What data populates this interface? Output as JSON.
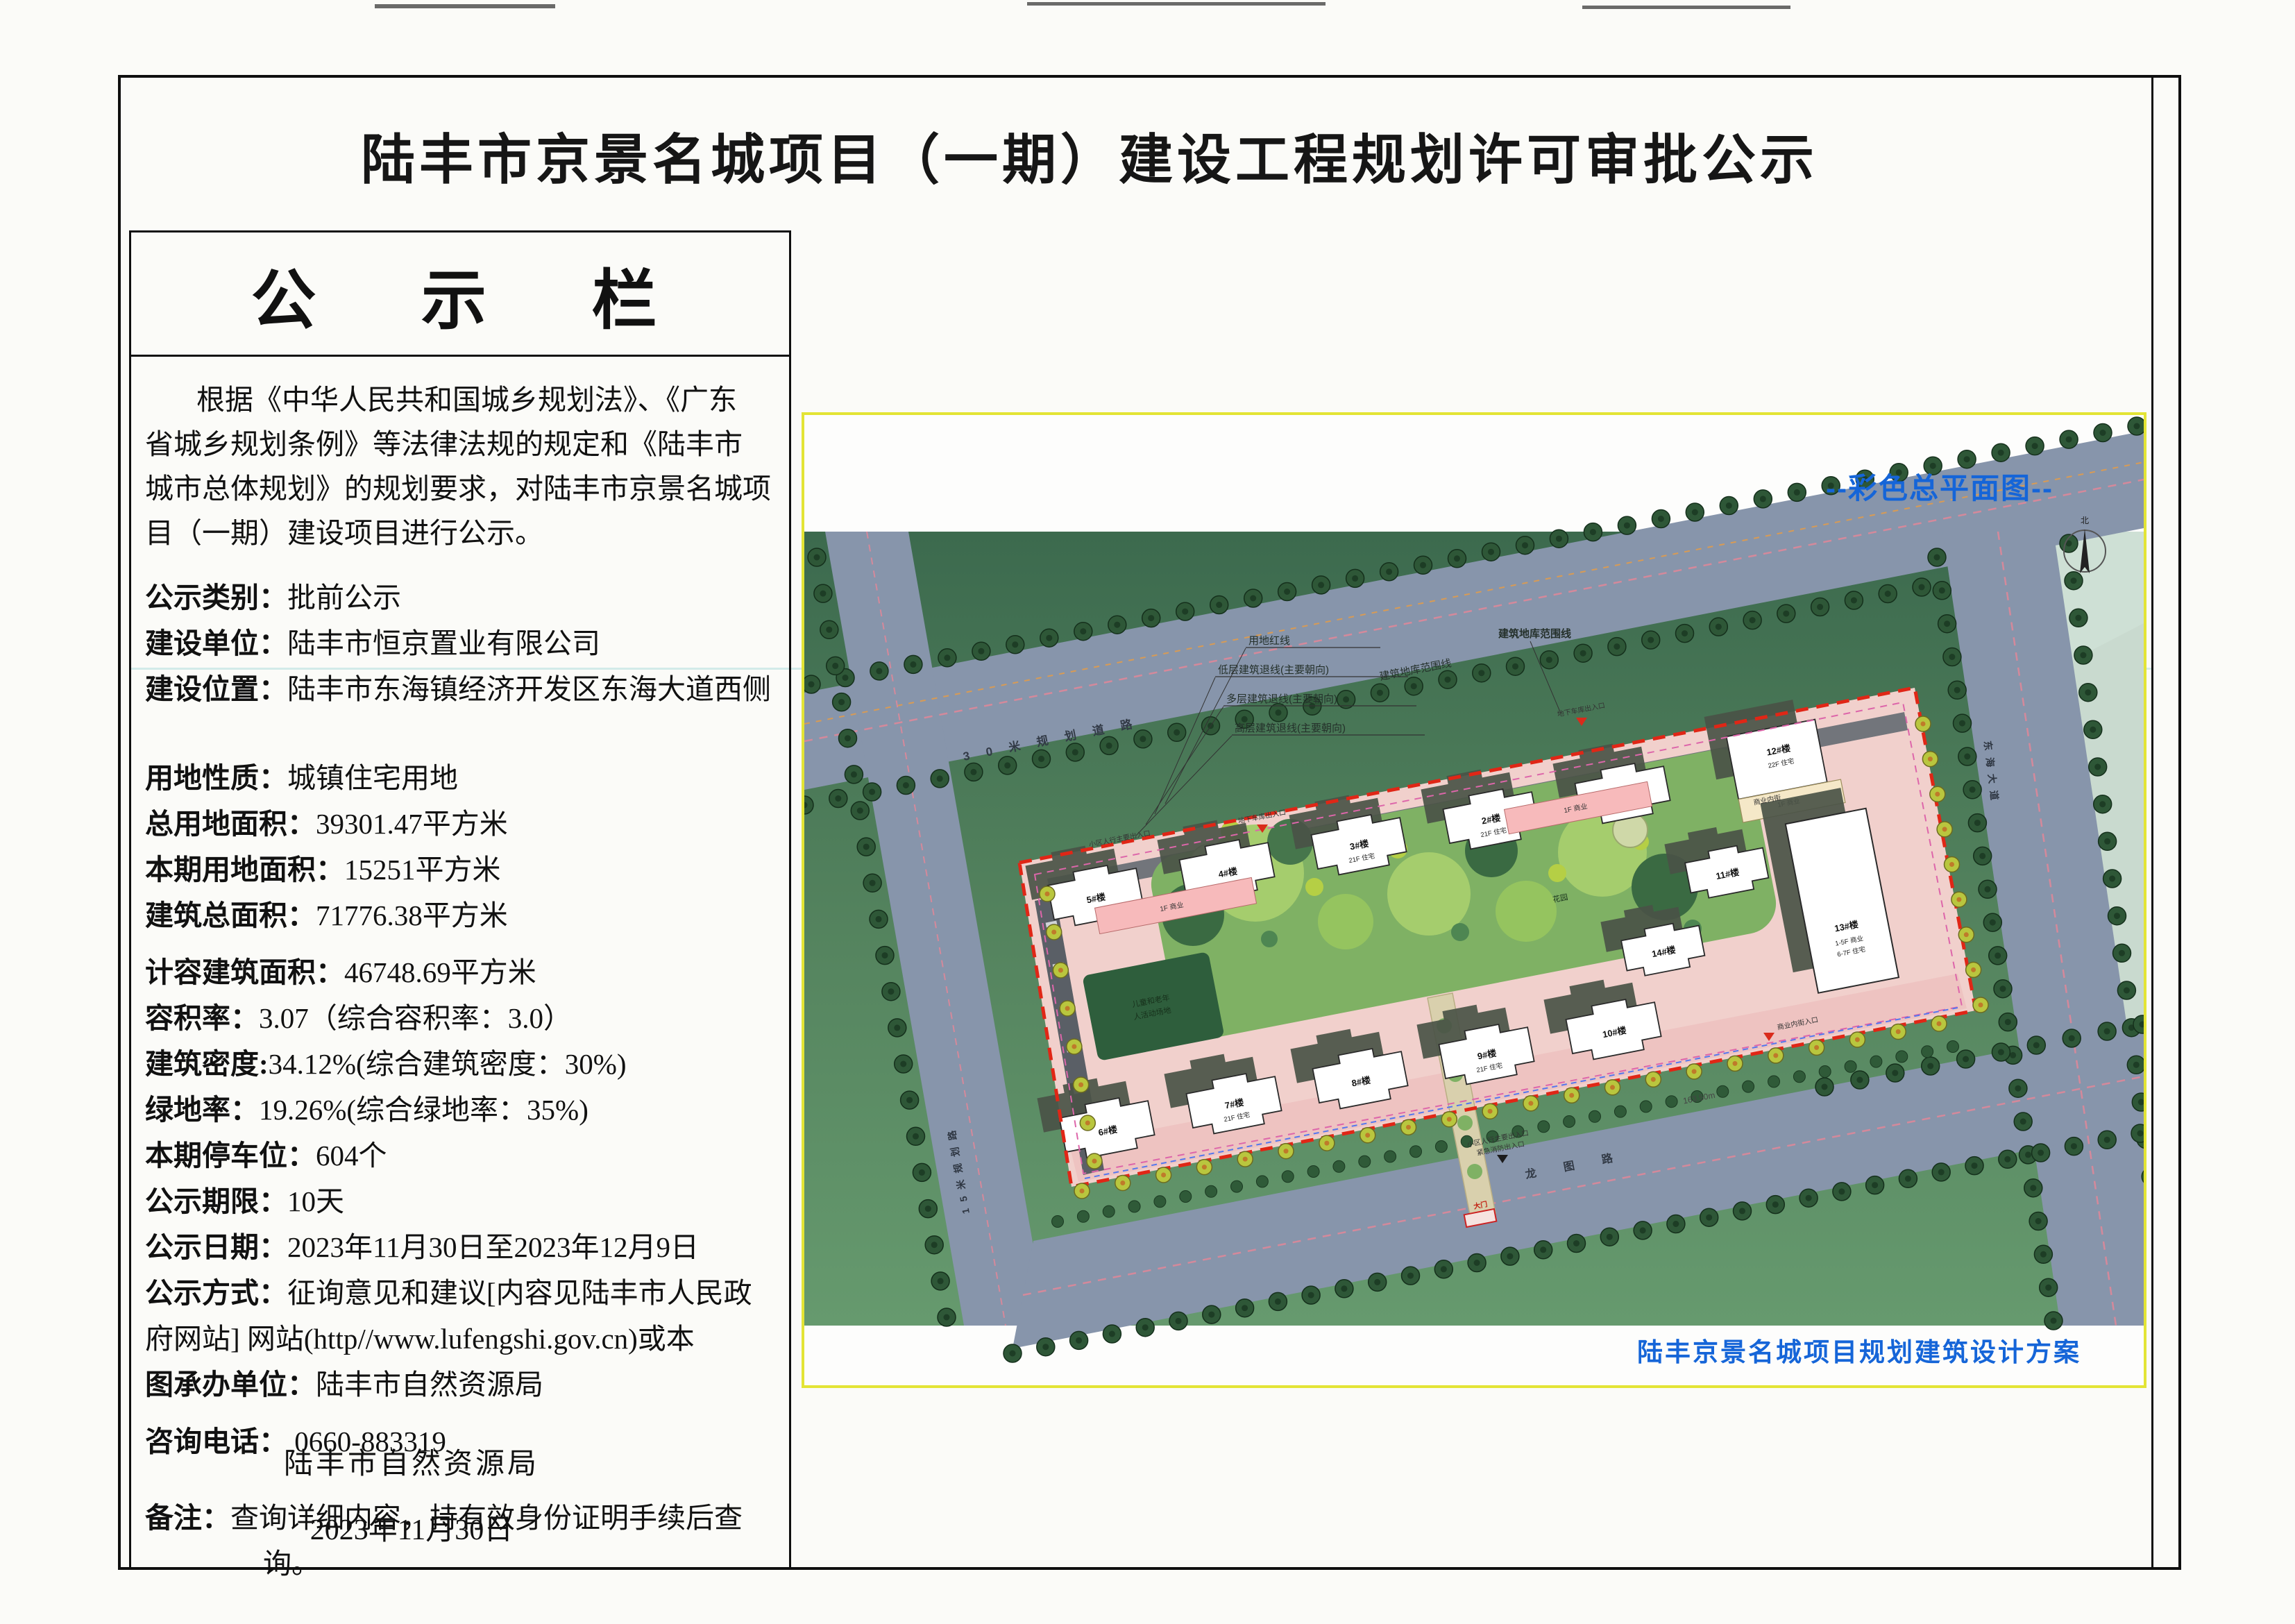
{
  "document": {
    "title": "陆丰市京景名城项目（一期）建设工程规划许可审批公示",
    "board_header": "公  示  栏",
    "intro_lines": [
      "根据《中华人民共和国城乡规划法》、《广东",
      "省城乡规划条例》等法律法规的规定和《陆丰市",
      "城市总体规划》的规划要求，对陆丰市京景名城项",
      "目（一期）建设项目进行公示。"
    ],
    "fields": [
      {
        "label": "公示类别：",
        "value": "批前公示"
      },
      {
        "label": "建设单位：",
        "value": "陆丰市恒京置业有限公司"
      },
      {
        "label": "建设位置：",
        "value": "陆丰市东海镇经济开发区东海大道西侧"
      },
      {
        "label": "用地性质：",
        "value": "城镇住宅用地"
      },
      {
        "label": "总用地面积：",
        "value": "39301.47平方米"
      },
      {
        "label": "本期用地面积：",
        "value": "15251平方米"
      },
      {
        "label": "建筑总面积：",
        "value": "71776.38平方米"
      },
      {
        "label": "计容建筑面积：",
        "value": "46748.69平方米"
      },
      {
        "label": "容积率：",
        "value": "3.07（综合容积率：3.0）"
      },
      {
        "label": "建筑密度:",
        "value": "34.12%(综合建筑密度：30%)"
      },
      {
        "label": "绿地率：",
        "value": "19.26%(综合绿地率：35%)"
      },
      {
        "label": "本期停车位：",
        "value": "604个"
      },
      {
        "label": "公示期限：",
        "value": "10天"
      },
      {
        "label": "公示日期：",
        "value": "2023年11月30日至2023年12月9日"
      },
      {
        "label": "公示方式：",
        "value": "征询意见和建议[内容见陆丰市人民政"
      },
      {
        "label": "",
        "value": "府网站] 网站(http//www.lufengshi.gov.cn)或本"
      },
      {
        "label": "图承办单位：",
        "value": "陆丰市自然资源局"
      },
      {
        "label": "咨询电话：",
        "value": "0660-883319"
      }
    ],
    "remark_label": "备注：",
    "remark_line1": "查询详细内容，持有效身份证明手续后查",
    "remark_line2": "询。",
    "signature_org": "陆丰市自然资源局",
    "signature_date": "2023年11月30日"
  },
  "site_plan": {
    "caption_top": "--彩色总平面图--",
    "caption_bottom": "陆丰京景名城项目规划建筑设计方案",
    "compass_label": "北",
    "roads": {
      "north": "30米规划道路",
      "south": "龙图路",
      "east": "东海大道",
      "west": "15米规划路"
    },
    "boundary_legend": [
      "用地红线",
      "低层建筑退线(主要朝向)",
      "多层建筑退线(主要朝向)",
      "高层建筑退线(主要朝向)"
    ],
    "garage_line_label": "建筑地库范围线",
    "entrances": {
      "garage": "地下车库出入口",
      "pedestrian": "小区人行主要出入口",
      "fire": "紧急消防出入口",
      "commercial": "商业内街入口",
      "gate": "大门"
    },
    "amenities": {
      "playground_line1": "儿童和老年",
      "playground_line2": "人活动场地",
      "garden": "花园",
      "inner_street": "商业内街"
    },
    "dimension_south": "163.50m",
    "buildings": [
      {
        "label": "1#楼"
      },
      {
        "label": "2#楼"
      },
      {
        "label": "3#楼"
      },
      {
        "label": "4#楼"
      },
      {
        "label": "5#楼"
      },
      {
        "label": "6#楼"
      },
      {
        "label": "7#楼"
      },
      {
        "label": "8#楼"
      },
      {
        "label": "9#楼"
      },
      {
        "label": "10#楼"
      },
      {
        "label": "11#楼"
      },
      {
        "label": "12#楼"
      },
      {
        "label": "13#楼"
      },
      {
        "label": "14#楼"
      }
    ],
    "building_notes": {
      "residential": "21F 住宅",
      "b12": "22F 住宅",
      "podium": "1F 商业",
      "b13_line1": "1-5F 商业",
      "b13_line2": "6-7F 住宅"
    },
    "colors": {
      "caption_blue": "#1565d8",
      "boundary_red": "#e02616",
      "parcel_pink": "#f1d0cc",
      "road_gray": "#8795ab",
      "field_green": "#4c7d58",
      "plan_border_yellow": "#e3e435"
    }
  }
}
